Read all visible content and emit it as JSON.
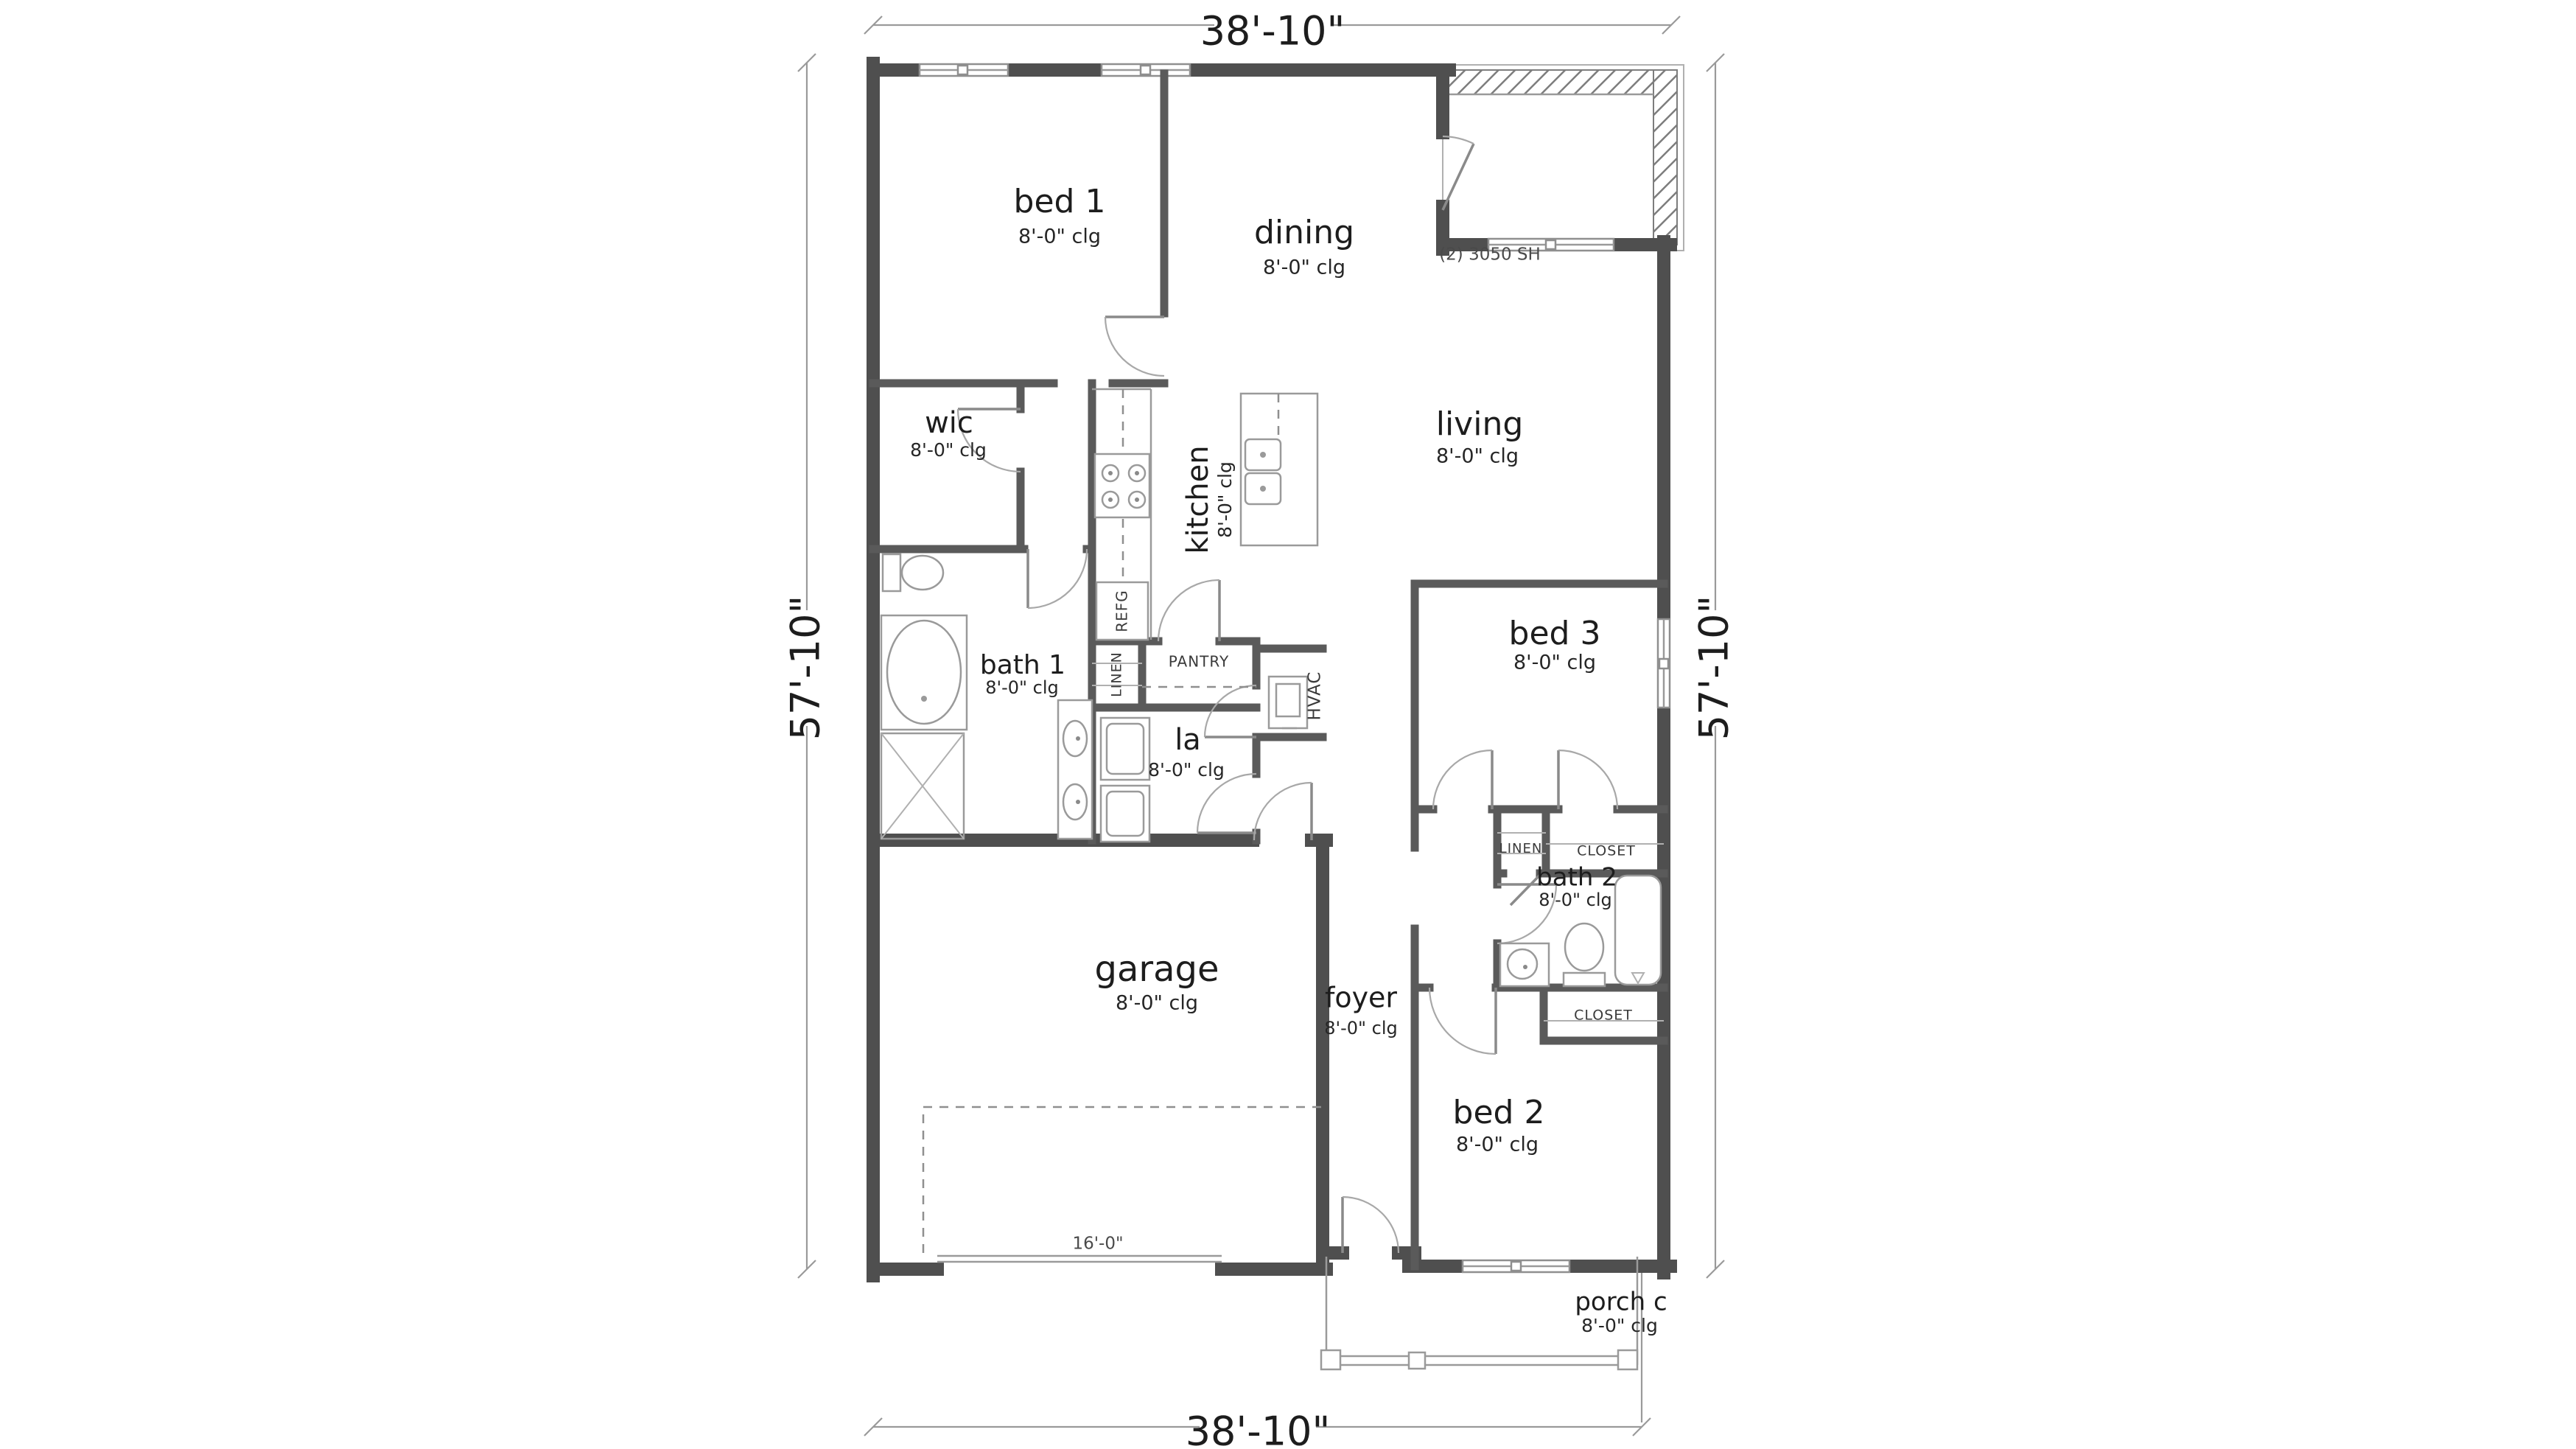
{
  "dimensions": {
    "width": "38'-10\"",
    "height": "57'-10\""
  },
  "rooms": [
    {
      "name": "bed 1",
      "clg": "8'-0\" clg"
    },
    {
      "name": "dining",
      "clg": "8'-0\" clg"
    },
    {
      "name": "living",
      "clg": "8'-0\" clg"
    },
    {
      "name": "wic",
      "clg": "8'-0\" clg"
    },
    {
      "name": "kitchen",
      "clg": "8'-0\" clg"
    },
    {
      "name": "bath 1",
      "clg": "8'-0\" clg"
    },
    {
      "name": "la",
      "clg": "8'-0\" clg"
    },
    {
      "name": "bed 3",
      "clg": "8'-0\" clg"
    },
    {
      "name": "garage",
      "clg": "8'-0\" clg"
    },
    {
      "name": "foyer",
      "clg": "8'-0\" clg"
    },
    {
      "name": "bath 2",
      "clg": "8'-0\" clg"
    },
    {
      "name": "bed 2",
      "clg": "8'-0\" clg"
    },
    {
      "name": "porch c",
      "clg": "8'-0\" clg"
    }
  ],
  "annotations": {
    "window_note": "(2) 3050 SH",
    "garage_door_width": "16'-0\"",
    "pantry": "PANTRY",
    "linen_hall": "LINEN",
    "linen_bath2": "LINEN",
    "closet_bath2": "CLOSET",
    "closet_bed2": "CLOSET",
    "hvac": "HVAC",
    "refrigerator": "REFG"
  },
  "colors": {
    "wall": "#4f4f4f",
    "line": "#9a9a9a",
    "text": "#1d1d1d",
    "background": "#ffffff"
  }
}
